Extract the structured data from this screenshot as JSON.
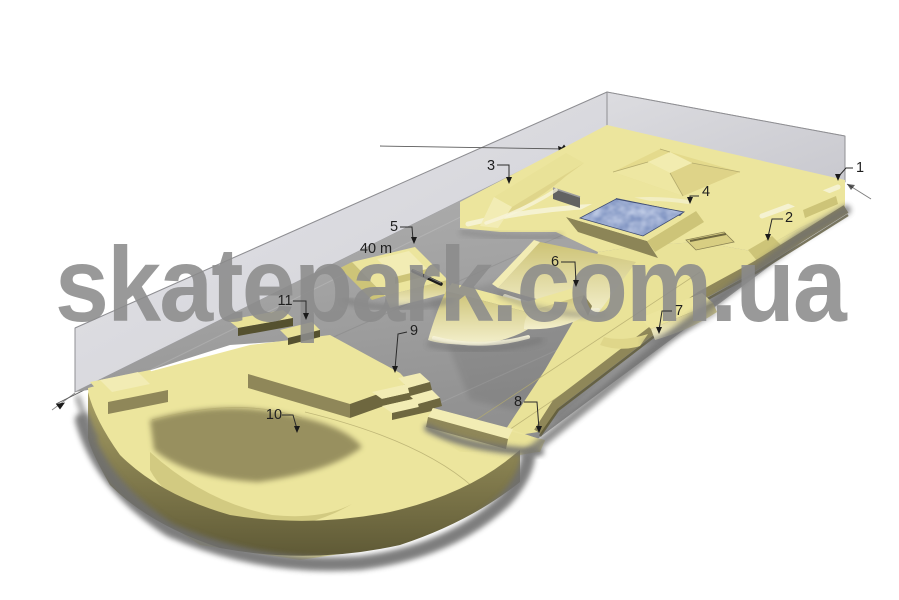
{
  "watermark": {
    "text": "skatepark.com.ua",
    "color": "#8b8b8b"
  },
  "dimension_label": "40 m",
  "callouts": [
    {
      "label": "1"
    },
    {
      "label": "2"
    },
    {
      "label": "3"
    },
    {
      "label": "4"
    },
    {
      "label": "5"
    },
    {
      "label": "6"
    },
    {
      "label": "7"
    },
    {
      "label": "8"
    },
    {
      "label": "9"
    },
    {
      "label": "10"
    },
    {
      "label": "11"
    }
  ],
  "palette": {
    "surface_yellow": "#ece59d",
    "highlight_yellow": "#f2ecb4",
    "side_olive": "#8f8759",
    "dark_olive": "#6e673f",
    "concrete_gray": "#a6a6a6",
    "glass_gray": "#d9d9dd",
    "water_blue": "#7288ba",
    "shadow_gray": "#6f6f6f",
    "annotation_ink": "#1f1f1f"
  }
}
